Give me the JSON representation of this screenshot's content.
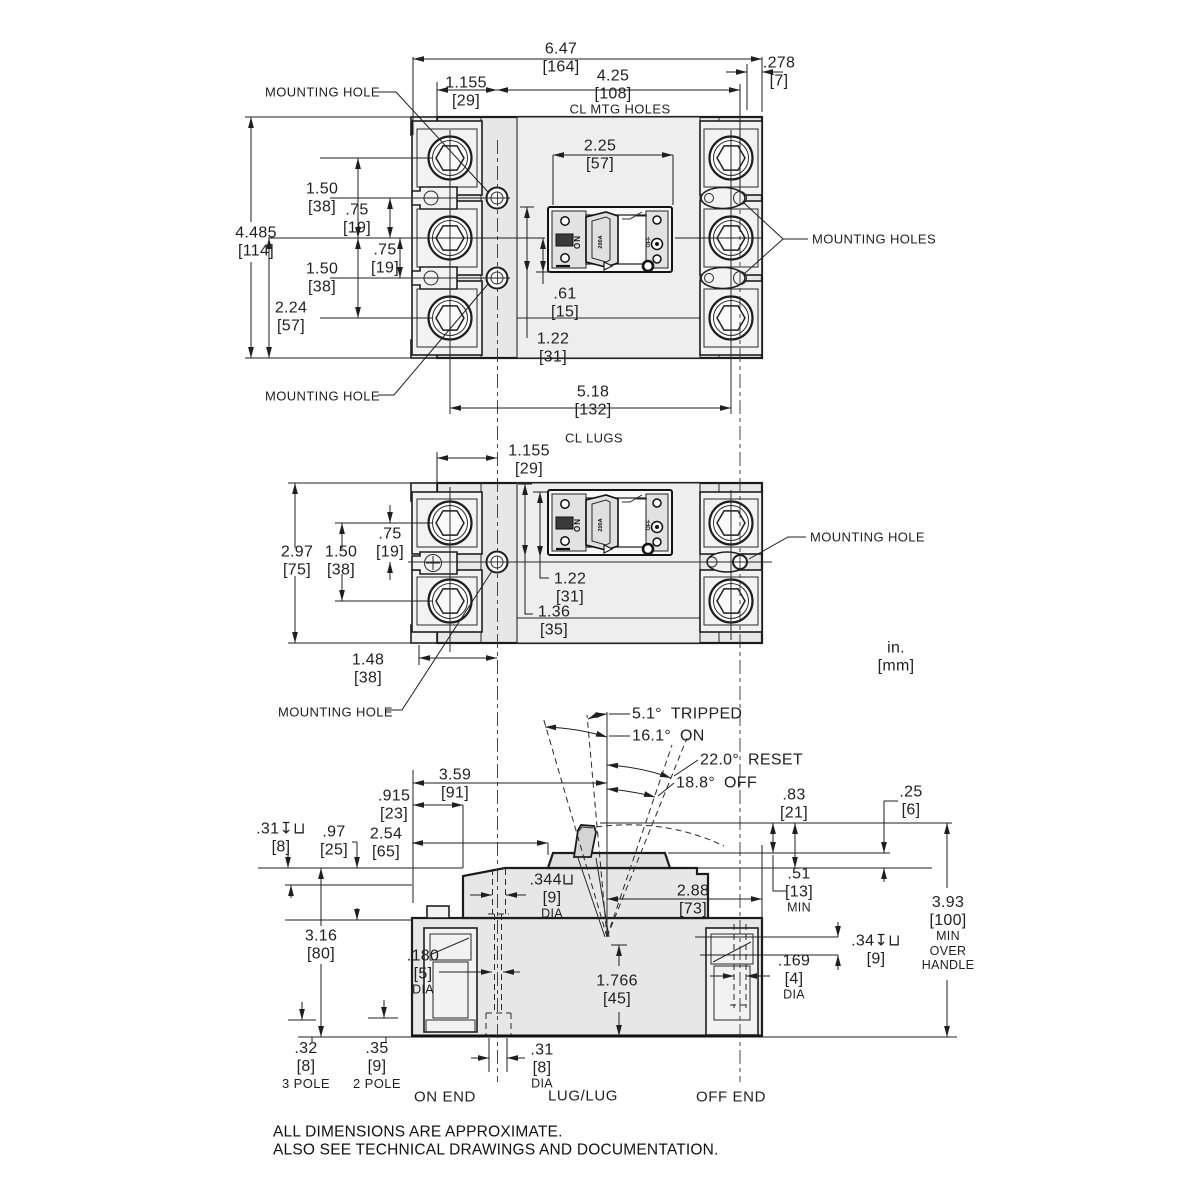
{
  "drawing": {
    "units_note": {
      "in": "in.",
      "mm": "[mm]"
    },
    "footer": {
      "line1": "ALL DIMENSIONS ARE APPROXIMATE.",
      "line2": "ALSO SEE TECHNICAL DRAWINGS AND DOCUMENTATION."
    },
    "switch_face": {
      "on": "ON",
      "off": "OFF",
      "rating": "200A"
    },
    "front_3pole": {
      "callout_mounting_hole_top": "MOUNTING HOLE",
      "callout_mounting_hole_bottom": "MOUNTING HOLE",
      "callout_mounting_holes_right": "MOUNTING HOLES",
      "dims": {
        "overall_width": {
          "in": "6.47",
          "mm": "[164]"
        },
        "mtg_hole_offset": {
          "in": "1.155",
          "mm": "[29]"
        },
        "mtg_hole_span": {
          "in": "4.25",
          "mm": "[108]",
          "note": "CL MTG HOLES"
        },
        "right_edge_offset": {
          "in": ".278",
          "mm": "[7]"
        },
        "handle_cutout_width": {
          "in": "2.25",
          "mm": "[57]"
        },
        "overall_height": {
          "in": "4.485",
          "mm": "[114]"
        },
        "pole_pitch_upper": {
          "in": "1.50",
          "mm": "[38]"
        },
        "hole_above_cl": {
          "in": ".75",
          "mm": "[19]"
        },
        "hole_below_cl": {
          "in": ".75",
          "mm": "[19]"
        },
        "pole_pitch_lower": {
          "in": "1.50",
          "mm": "[38]"
        },
        "cl_to_bottom": {
          "in": "2.24",
          "mm": "[57]"
        },
        "cutout_half_height": {
          "in": ".61",
          "mm": "[15]"
        },
        "cutout_height": {
          "in": "1.22",
          "mm": "[31]"
        },
        "lug_cl_span": {
          "in": "5.18",
          "mm": "[132]",
          "note": "CL LUGS"
        }
      }
    },
    "front_2pole": {
      "callout_mounting_hole_right": "MOUNTING HOLE",
      "callout_mounting_hole_bottom": "MOUNTING HOLE",
      "dims": {
        "mtg_hole_offset": {
          "in": "1.155",
          "mm": "[29]"
        },
        "overall_height": {
          "in": "2.97",
          "mm": "[75]"
        },
        "pole_pitch": {
          "in": "1.50",
          "mm": "[38]"
        },
        "hole_below_cl": {
          "in": ".75",
          "mm": "[19]"
        },
        "cutout_height": {
          "in": "1.22",
          "mm": "[31]"
        },
        "top_to_cutout_bottom": {
          "in": "1.36",
          "mm": "[35]"
        },
        "edge_to_mtg_hole": {
          "in": "1.48",
          "mm": "[38]"
        }
      }
    },
    "side_view": {
      "handle_angles": {
        "tripped": {
          "deg": "5.1°",
          "label": "TRIPPED"
        },
        "on": {
          "deg": "16.1°",
          "label": "ON"
        },
        "reset": {
          "deg": "22.0°",
          "label": "RESET"
        },
        "off": {
          "deg": "18.8°",
          "label": "OFF"
        }
      },
      "dims": {
        "edge_to_handle_cl": {
          "in": "3.59",
          "mm": "[91]"
        },
        "edge_to_step": {
          "in": ".915",
          "mm": "[23]"
        },
        "edge_to_pedestal": {
          "in": "2.54",
          "mm": "[65]"
        },
        "recess_depth": {
          "in": ".31↧⊔",
          "mm": "[8]"
        },
        "cover_depth": {
          "in": ".97",
          "mm": "[25]"
        },
        "mtg_hole_dia": {
          "in": ".344⊔",
          "mm": "[9]",
          "note": "DIA"
        },
        "handle_cl_to_edge": {
          "in": "2.88",
          "mm": "[73]"
        },
        "handle_height": {
          "in": ".83",
          "mm": "[21]"
        },
        "pedestal_height": {
          "in": ".25",
          "mm": "[6]"
        },
        "handle_clearance": {
          "in": ".51",
          "mm": "[13]",
          "note": "MIN"
        },
        "mtg_hole_depth": {
          "in": ".34↧⊔",
          "mm": "[9]"
        },
        "min_over_handle": {
          "in": "3.93",
          "mm": "[100]",
          "note1": "MIN",
          "note2": "OVER",
          "note3": "HANDLE"
        },
        "body_height": {
          "in": "3.16",
          "mm": "[80]"
        },
        "wire_hole_dia": {
          "in": ".180",
          "mm": "[5]",
          "note": "DIA"
        },
        "base_height": {
          "in": "1.766",
          "mm": "[45]"
        },
        "off_hole_dia": {
          "in": ".169",
          "mm": "[4]",
          "note": "DIA"
        },
        "foot_3pole": {
          "in": ".32",
          "mm": "[8]",
          "note": "3 POLE"
        },
        "foot_2pole": {
          "in": ".35",
          "mm": "[9]",
          "note": "2 POLE"
        },
        "bottom_hole_dia": {
          "in": ".31",
          "mm": "[8]",
          "note": "DIA"
        }
      },
      "end_labels": {
        "on_end": "ON END",
        "lug_lug": "LUG/LUG",
        "off_end": "OFF END"
      }
    }
  }
}
